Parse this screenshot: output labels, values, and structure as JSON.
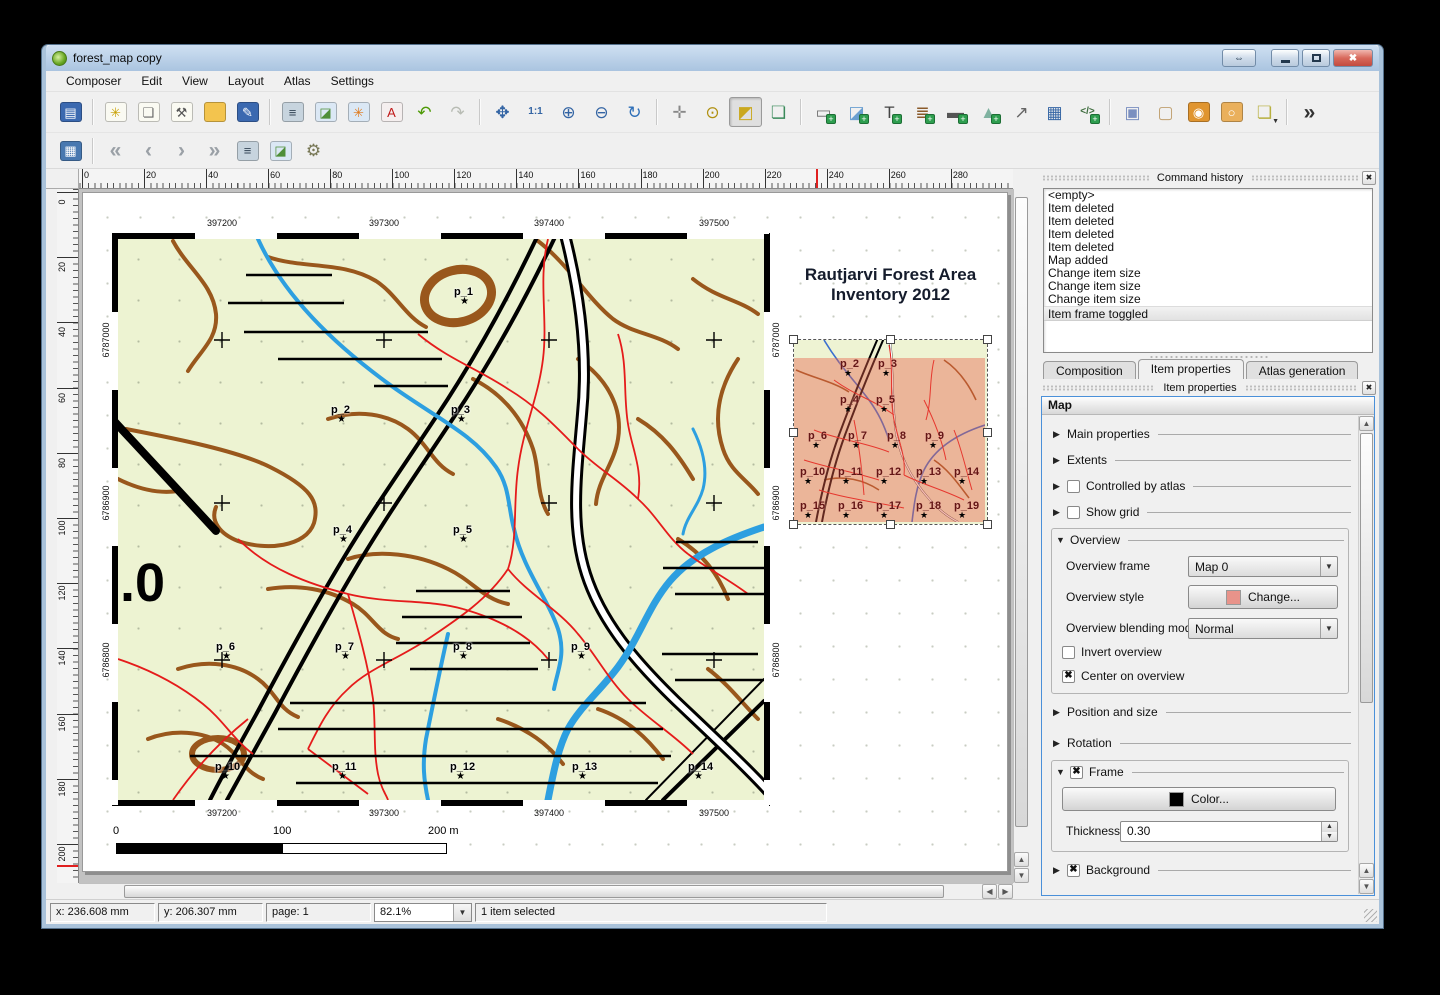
{
  "window": {
    "title": "forest_map copy"
  },
  "icons": {
    "collapsed": "▶",
    "expanded": "▼",
    "combo": "▼",
    "spin_up": "▲",
    "spin_down": "▼",
    "check": "✖",
    "close": "✖",
    "shade": "⇔",
    "star": "★",
    "left": "◀",
    "right": "▶",
    "up": "▲",
    "down": "▼",
    "overflow": "»"
  },
  "menu": {
    "items": [
      "Composer",
      "Edit",
      "View",
      "Layout",
      "Atlas",
      "Settings"
    ]
  },
  "toolbar_main": [
    {
      "name": "save-project",
      "glyph": "▤",
      "fg": "#ffffff",
      "bg": "#3b69b0"
    },
    {
      "sep": true
    },
    {
      "name": "new-composition",
      "glyph": "✳",
      "fg": "#c8a000",
      "bg": "#fafaf2"
    },
    {
      "name": "duplicate-composition",
      "glyph": "❏",
      "fg": "#666666",
      "bg": "#fafaf2"
    },
    {
      "name": "composition-manager",
      "glyph": "⚒",
      "fg": "#555555",
      "bg": "#fafaf2"
    },
    {
      "name": "open-composition",
      "glyph": "",
      "fg": "#a87818",
      "bg": "#f3c44e"
    },
    {
      "name": "save-as-template",
      "glyph": "✎",
      "fg": "#ffffff",
      "bg": "#3b69b0"
    },
    {
      "sep": true
    },
    {
      "name": "print",
      "glyph": "≡",
      "fg": "#334455",
      "bg": "#c7d4de"
    },
    {
      "name": "export-as-image",
      "glyph": "◪",
      "fg": "#4f8f3a",
      "bg": "#dbe8f5"
    },
    {
      "name": "export-as-svg",
      "glyph": "✳",
      "fg": "#e07818",
      "bg": "#dbe8f5"
    },
    {
      "name": "export-as-pdf",
      "glyph": "A",
      "fg": "#c01818",
      "bg": "#f5efef"
    },
    {
      "name": "undo",
      "glyph": "↶",
      "fg": "#4e9a06"
    },
    {
      "name": "redo",
      "glyph": "↷",
      "fg": "#b8bcb4"
    },
    {
      "sep": true
    },
    {
      "name": "zoom-full",
      "glyph": "✥",
      "fg": "#3465a4"
    },
    {
      "name": "zoom-actual-size",
      "glyph": "1:1",
      "fg": "#3465a4",
      "small": true
    },
    {
      "name": "zoom-in",
      "glyph": "⊕",
      "fg": "#3465a4"
    },
    {
      "name": "zoom-out",
      "glyph": "⊖",
      "fg": "#3465a4"
    },
    {
      "name": "refresh-view",
      "glyph": "↻",
      "fg": "#2e6fb8"
    },
    {
      "sep": true
    },
    {
      "name": "pan",
      "glyph": "✛",
      "fg": "#888888"
    },
    {
      "name": "zoom-region",
      "glyph": "⊙",
      "fg": "#b09010"
    },
    {
      "name": "select-move-item",
      "glyph": "◩",
      "fg": "#caa81e",
      "pressed": true
    },
    {
      "name": "move-item-content",
      "glyph": "❏",
      "fg": "#3a8a5a"
    },
    {
      "sep": true
    },
    {
      "name": "add-new-map",
      "glyph": "▭",
      "fg": "#777777",
      "plus": true
    },
    {
      "name": "add-image",
      "glyph": "◪",
      "fg": "#6a9fd0",
      "plus": true
    },
    {
      "name": "add-label",
      "glyph": "T",
      "fg": "#444444",
      "plus": true
    },
    {
      "name": "add-legend",
      "glyph": "≣",
      "fg": "#8a5a2a",
      "plus": true
    },
    {
      "name": "add-scalebar",
      "glyph": "▬",
      "fg": "#555555",
      "plus": true
    },
    {
      "name": "add-basic-shape",
      "glyph": "▲",
      "fg": "#7fb2a0",
      "plus": true
    },
    {
      "name": "add-arrow",
      "glyph": "↗",
      "fg": "#666666"
    },
    {
      "name": "add-attribute-table",
      "glyph": "▦",
      "fg": "#3465a4"
    },
    {
      "name": "add-html-frame",
      "glyph": "</>",
      "fg": "#3a6a3a",
      "plus": true,
      "small": true
    },
    {
      "sep": true
    },
    {
      "name": "group-items",
      "glyph": "▣",
      "fg": "#7a8fc0"
    },
    {
      "name": "ungroup-items",
      "glyph": "▢",
      "fg": "#c0a070"
    },
    {
      "name": "lock-selected-items",
      "glyph": "◉",
      "fg": "#ffffff",
      "bg": "#e09530"
    },
    {
      "name": "unlock-all-items",
      "glyph": "○",
      "fg": "#ffffff",
      "bg": "#eab05c"
    },
    {
      "name": "raise-selected-items",
      "glyph": "❏",
      "fg": "#b8b040",
      "dropdown": true
    },
    {
      "sep": true
    },
    {
      "name": "toolbar-overflow",
      "glyph": "»",
      "fg": "#333333",
      "big": true
    }
  ],
  "toolbar_atlas": [
    {
      "name": "preview-atlas",
      "glyph": "▦",
      "fg": "#ffffff",
      "bg": "#4878b0"
    },
    {
      "sep": true
    },
    {
      "name": "first-feature",
      "glyph": "«",
      "fg": "#9aa0a6",
      "big": true
    },
    {
      "name": "previous-feature",
      "glyph": "‹",
      "fg": "#9aa0a6",
      "big": true
    },
    {
      "name": "next-feature",
      "glyph": "›",
      "fg": "#9aa0a6",
      "big": true
    },
    {
      "name": "last-feature",
      "glyph": "»",
      "fg": "#9aa0a6",
      "big": true
    },
    {
      "name": "print-atlas",
      "glyph": "≡",
      "fg": "#334455",
      "bg": "#c7d4de"
    },
    {
      "name": "export-atlas-as-image",
      "glyph": "◪",
      "fg": "#4f8f3a",
      "bg": "#dbe8f5"
    },
    {
      "name": "atlas-settings",
      "glyph": "⚙",
      "fg": "#777755"
    }
  ],
  "rulers": {
    "h_ticks": [
      0,
      20,
      40,
      60,
      80,
      100,
      120,
      140,
      160,
      180,
      200,
      220,
      240,
      260,
      280,
      300
    ],
    "v_ticks": [
      0,
      20,
      40,
      60,
      80,
      100,
      120,
      140,
      160,
      180,
      200
    ],
    "h_marker_mm": 236.608,
    "v_marker_mm": 206.307
  },
  "page": {
    "title_line1": "Rautjarvi Forest Area",
    "title_line2": "Inventory 2012",
    "map": {
      "x_ticks": [
        "397200",
        "397300",
        "397400",
        "397500"
      ],
      "y_ticks": [
        "6787000",
        "6786900",
        "6786800"
      ],
      "road_label": ".0",
      "points": [
        {
          "label": "p_1",
          "x": 352,
          "y": 56
        },
        {
          "label": "p_2",
          "x": 229,
          "y": 174
        },
        {
          "label": "p_3",
          "x": 349,
          "y": 174
        },
        {
          "label": "p_4",
          "x": 231,
          "y": 294
        },
        {
          "label": "p_5",
          "x": 351,
          "y": 294
        },
        {
          "label": "p_6",
          "x": 114,
          "y": 411
        },
        {
          "label": "p_7",
          "x": 233,
          "y": 411
        },
        {
          "label": "p_8",
          "x": 351,
          "y": 411
        },
        {
          "label": "p_9",
          "x": 469,
          "y": 411
        },
        {
          "label": "p_10",
          "x": 113,
          "y": 531
        },
        {
          "label": "p_11",
          "x": 230,
          "y": 531
        },
        {
          "label": "p_12",
          "x": 348,
          "y": 531
        },
        {
          "label": "p_13",
          "x": 470,
          "y": 531
        },
        {
          "label": "p_14",
          "x": 586,
          "y": 531
        }
      ]
    },
    "scalebar": {
      "labels": [
        "0",
        "100",
        "200 m"
      ]
    },
    "overview": {
      "points": [
        {
          "label": "p_2",
          "x": 46,
          "y": 14
        },
        {
          "label": "p_3",
          "x": 84,
          "y": 14
        },
        {
          "label": "p_4",
          "x": 46,
          "y": 50
        },
        {
          "label": "p_5",
          "x": 82,
          "y": 50
        },
        {
          "label": "p_6",
          "x": 14,
          "y": 86
        },
        {
          "label": "p_7",
          "x": 54,
          "y": 86
        },
        {
          "label": "p_8",
          "x": 93,
          "y": 86
        },
        {
          "label": "p_9",
          "x": 131,
          "y": 86
        },
        {
          "label": "p_10",
          "x": 6,
          "y": 122
        },
        {
          "label": "p_11",
          "x": 44,
          "y": 122
        },
        {
          "label": "p_12",
          "x": 82,
          "y": 122
        },
        {
          "label": "p_13",
          "x": 122,
          "y": 122
        },
        {
          "label": "p_14",
          "x": 160,
          "y": 122
        },
        {
          "label": "p_15",
          "x": 6,
          "y": 156
        },
        {
          "label": "p_16",
          "x": 44,
          "y": 156
        },
        {
          "label": "p_17",
          "x": 82,
          "y": 156
        },
        {
          "label": "p_18",
          "x": 122,
          "y": 156
        },
        {
          "label": "p_19",
          "x": 160,
          "y": 156
        }
      ]
    }
  },
  "command_history": {
    "title": "Command history",
    "items": [
      "<empty>",
      "Item deleted",
      "Item deleted",
      "Item deleted",
      "Item deleted",
      "Map added",
      "Change item size",
      "Change item size",
      "Change item size",
      "Item frame toggled"
    ],
    "selected_index": 9
  },
  "tabs": [
    {
      "label": "Composition",
      "active": false
    },
    {
      "label": "Item properties",
      "active": true
    },
    {
      "label": "Atlas generation",
      "active": false
    }
  ],
  "item_properties": {
    "panel_title": "Item properties",
    "header": "Map",
    "sections": {
      "main_properties": "Main properties",
      "extents": "Extents",
      "controlled_by_atlas": "Controlled by atlas",
      "show_grid": "Show grid",
      "overview": {
        "label": "Overview",
        "frame_label": "Overview frame",
        "frame_value": "Map 0",
        "style_label": "Overview style",
        "change_button": "Change...",
        "blending_label": "Overview blending mode",
        "blending_value": "Normal",
        "invert_label": "Invert overview",
        "center_label": "Center on overview"
      },
      "position_and_size": "Position and size",
      "rotation": "Rotation",
      "frame": {
        "label": "Frame",
        "color_button": "Color...",
        "thickness_label": "Thickness",
        "thickness_value": "0.30"
      },
      "background": {
        "label": "Background"
      }
    }
  },
  "statusbar": {
    "x": "x: 236.608 mm",
    "y": "y: 206.307 mm",
    "page": "page: 1",
    "zoom": "82.1%",
    "message": "1 item selected"
  },
  "colors": {
    "overview_style_swatch": "#e8938a",
    "frame_color_swatch": "#000000",
    "selection_blue": "#4a90d9"
  }
}
